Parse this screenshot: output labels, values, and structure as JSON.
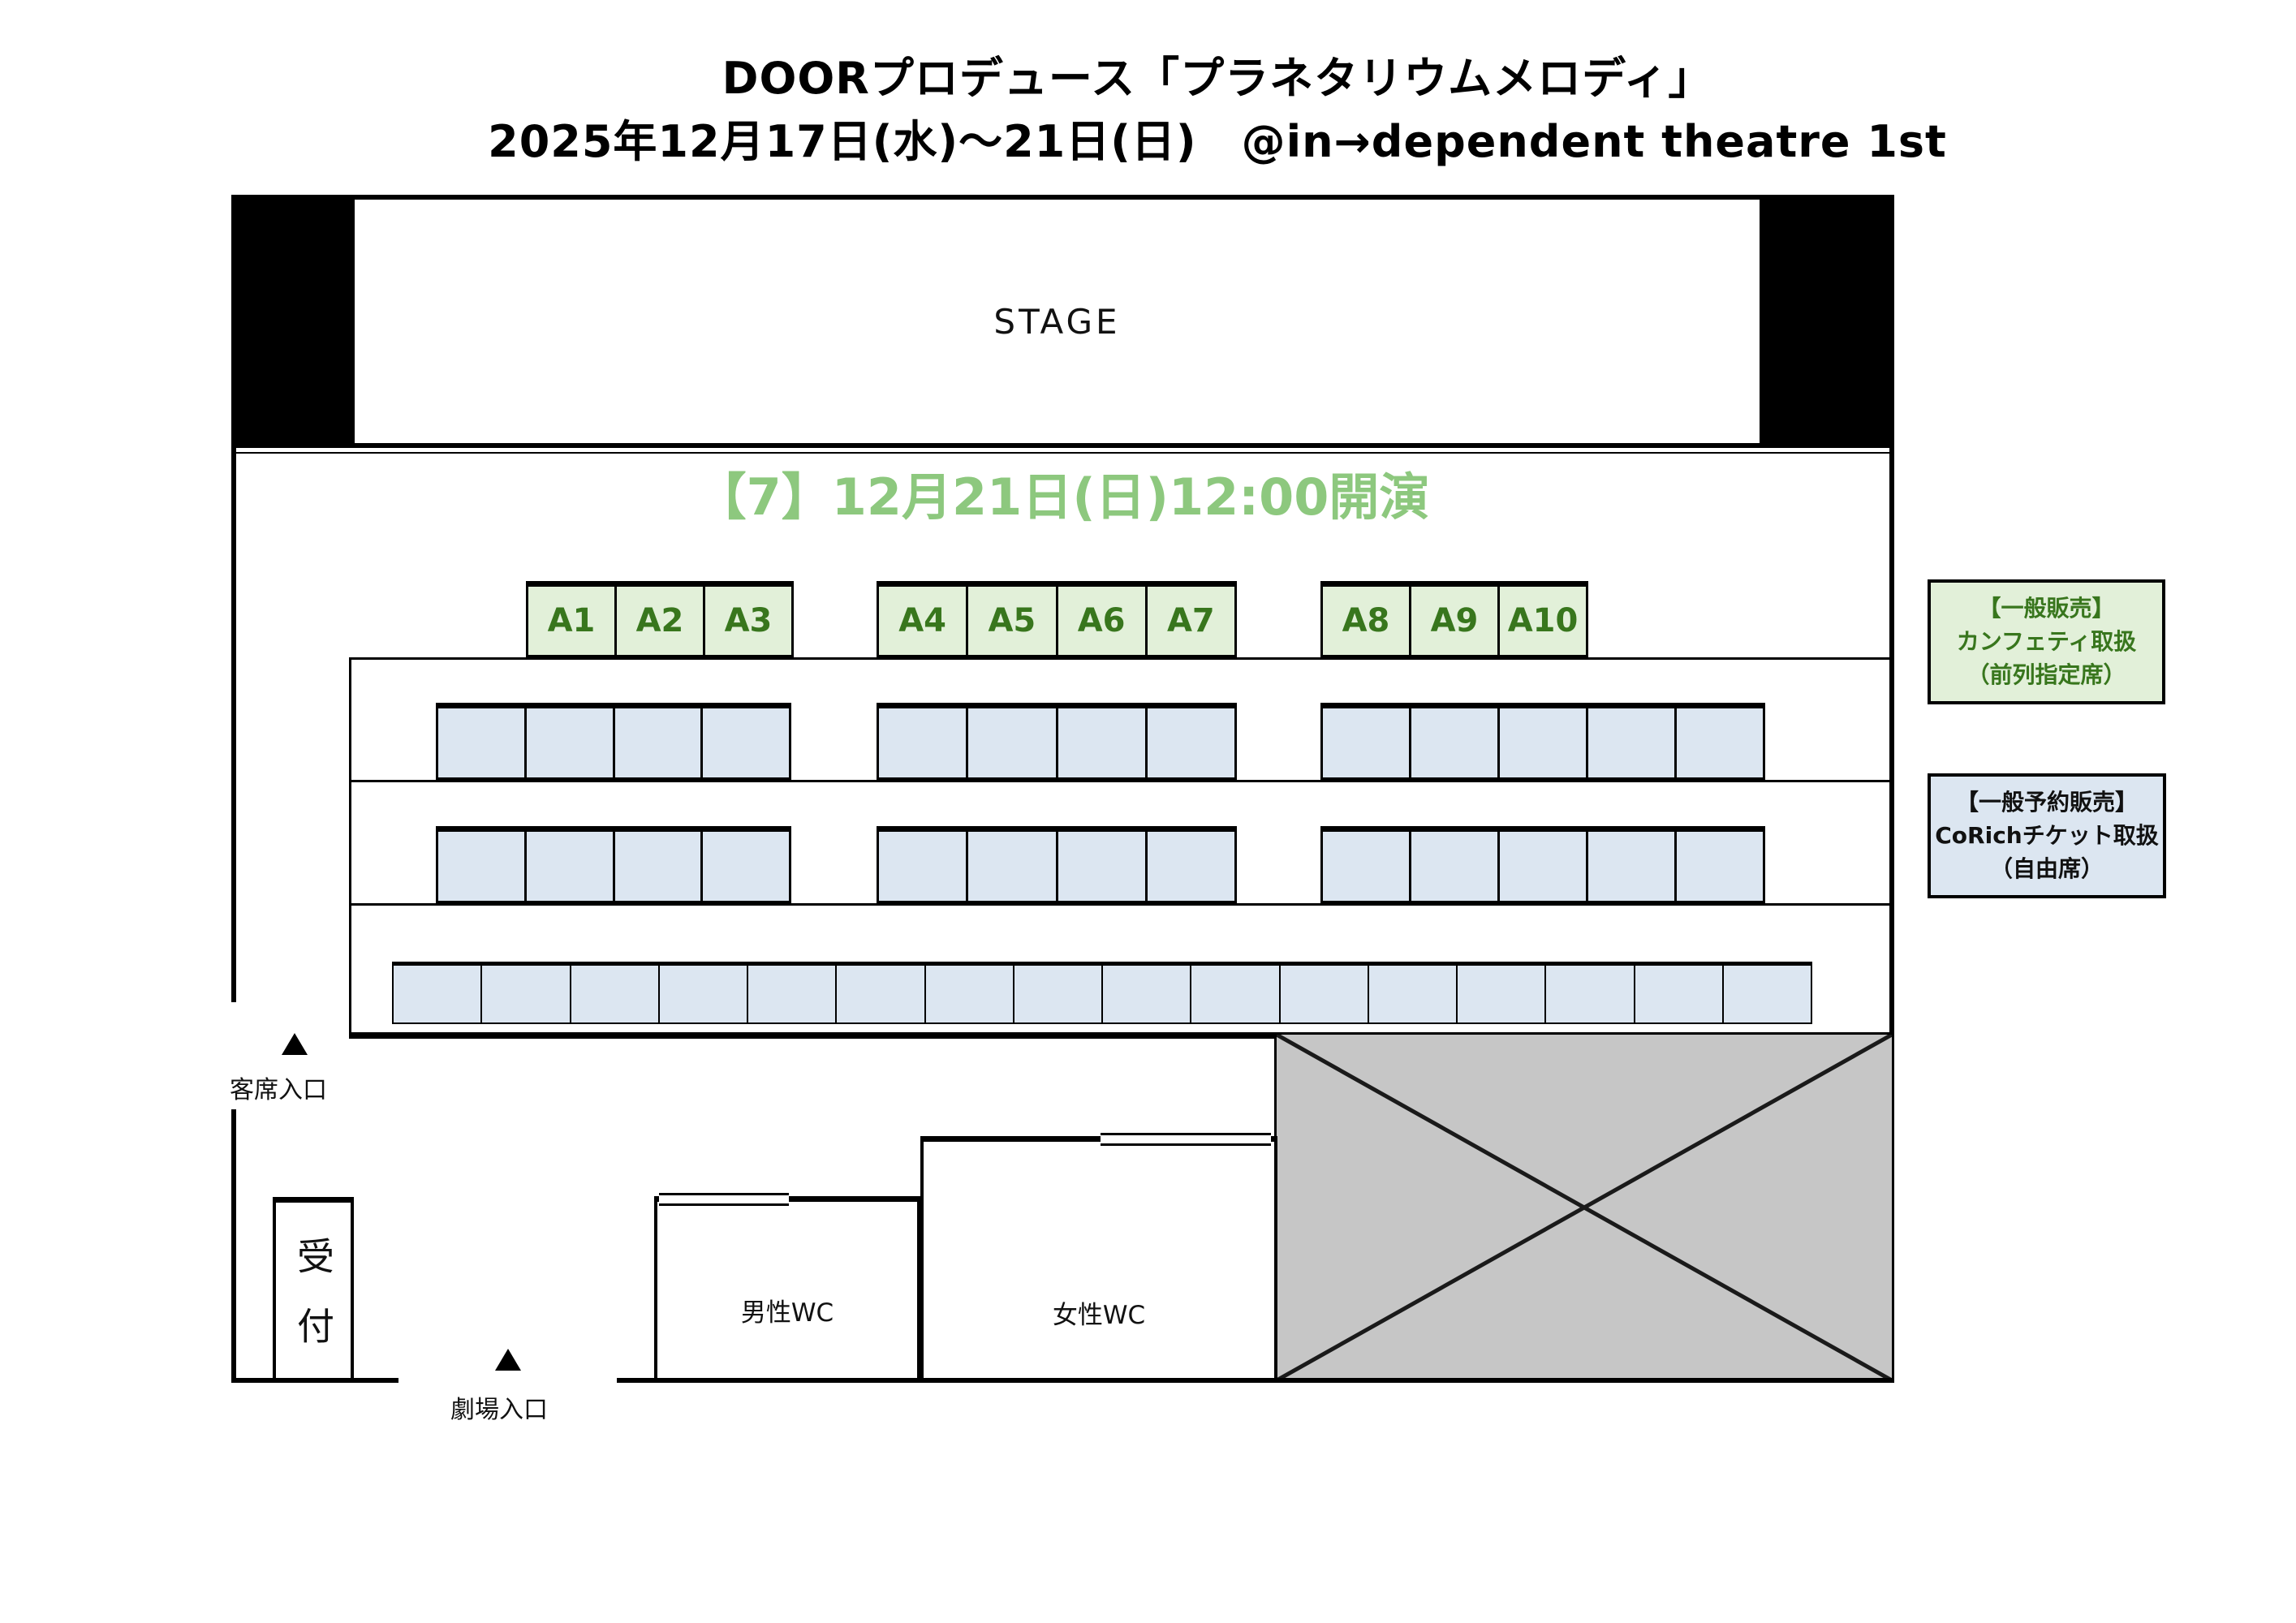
{
  "title": {
    "line1": "DOORプロデュース「プラネタリウムメロディ」",
    "line2": "2025年12月17日(水)〜21日(日)　@in→dependent theatre 1st"
  },
  "stage": {
    "label": "STAGE"
  },
  "session": {
    "heading": "【7】12月21日(日)12:00開演",
    "color": "#8dc87e"
  },
  "seating": {
    "front_fill": "#e2f0d9",
    "front_text_color": "#38761d",
    "general_fill": "#dce6f1",
    "rows": {
      "front": {
        "groups": [
          [
            "A1",
            "A2",
            "A3"
          ],
          [
            "A4",
            "A5",
            "A6",
            "A7"
          ],
          [
            "A8",
            "A9",
            "A10"
          ]
        ]
      },
      "mid1": {
        "groups": [
          4,
          4,
          5
        ]
      },
      "mid2": {
        "groups": [
          4,
          4,
          5
        ]
      },
      "back": {
        "groups": [
          16
        ]
      }
    }
  },
  "legend": {
    "general_sale": {
      "lines": [
        "【一般販売】",
        "カンフェティ取扱",
        "（前列指定席）"
      ],
      "fill": "#e2f0d9",
      "text_color": "#38761d"
    },
    "reserve_sale": {
      "lines": [
        "【一般予約販売】",
        "CoRichチケット取扱",
        "（自由席）"
      ],
      "fill": "#dce6f1",
      "text_color": "#111111"
    }
  },
  "facilities": {
    "reception": "受付",
    "mens_wc": "男性WC",
    "womens_wc": "女性WC"
  },
  "entrances": {
    "audience": "客席入口",
    "theater": "劇場入口"
  },
  "blocked": {
    "fill": "#c6c6c6"
  }
}
